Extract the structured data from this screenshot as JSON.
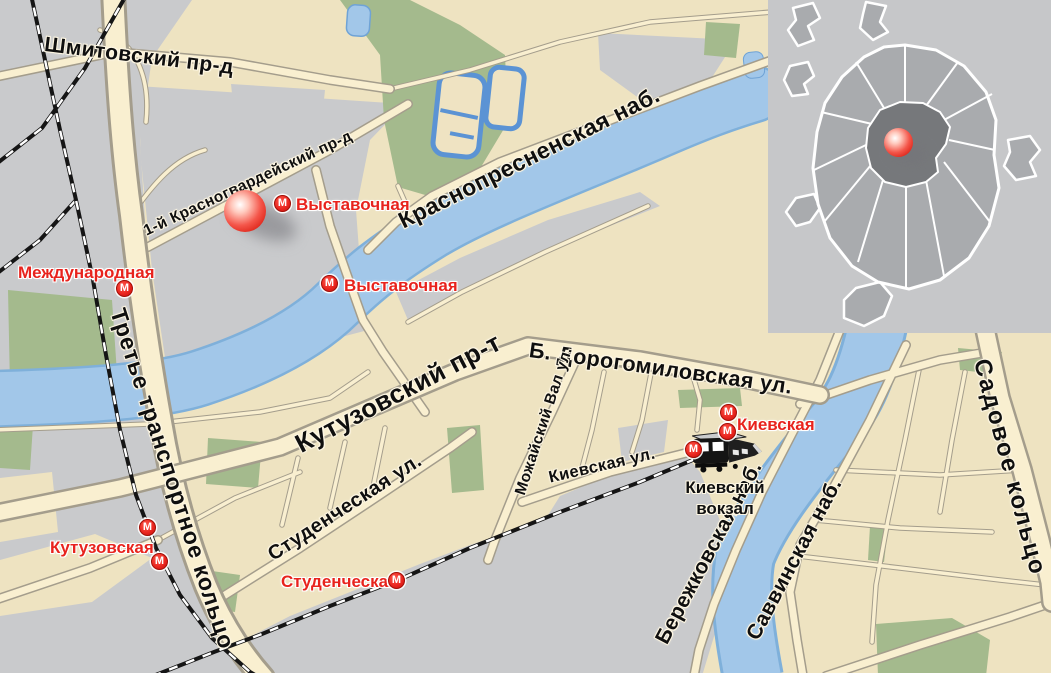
{
  "metro": {
    "symbol": "М",
    "color": "#e8231d"
  },
  "streets": {
    "shmitovsky": "Шмитовский пр-д",
    "krasnogvardeysky": "1-й Красногвардейский пр-д",
    "krasnopresnenskaya": "Краснопресненская наб.",
    "kutuzovsky": "Кутузовский пр-т",
    "dorogomilovskaya": "Б. Дорогомиловская ул.",
    "mozhaysky_val": "Можайский Вал ул.",
    "studencheskaya_st": "Студенческая ул.",
    "kievskaya_st": "Киевская ул.",
    "berezhkovskaya": "Бережковская наб.",
    "savvinskaya": "Саввинская наб.",
    "sadovoe": "Садовое кольцо",
    "third_ring": "Третье транспортное кольцо"
  },
  "stations": {
    "vystavochnaya_1": "Выставочная",
    "vystavochnaya_2": "Выставочная",
    "mezhdunarodnaya": "Международная",
    "kutuzovskaya": "Кутузовская",
    "studencheskaya": "Студенческая",
    "kievskaya": "Киевская"
  },
  "kiev_terminal": {
    "line1": "Киевский",
    "line2": "вокзал"
  },
  "colors": {
    "land": "#eee3c1",
    "industrial": "#c9cacc",
    "water": "#a2c7e9",
    "park": "#a4ba8d",
    "road": "#f9efd0",
    "marker_red": "#e02a1e",
    "inset_bg": "#c6c7c9",
    "inset_city": "#a9abae",
    "inset_center": "#76787b"
  }
}
